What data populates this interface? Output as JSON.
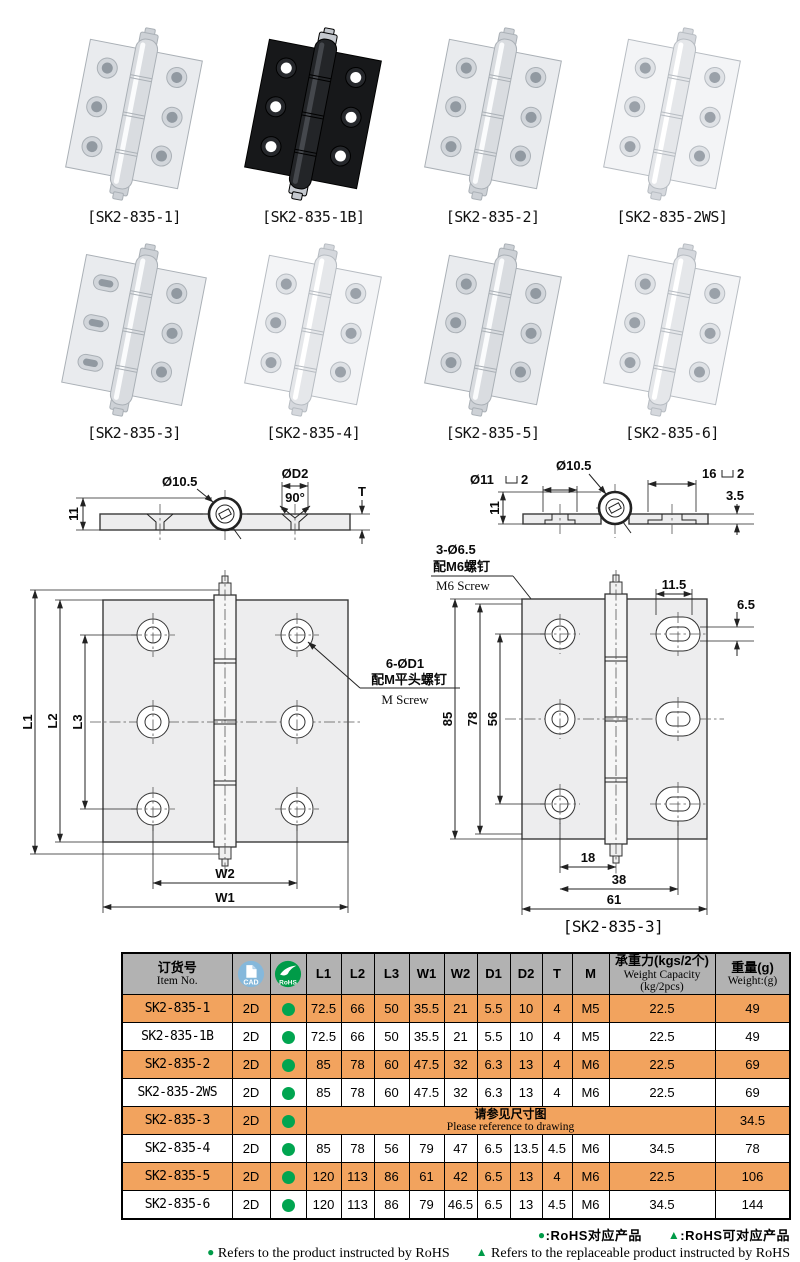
{
  "products": [
    {
      "label": "[SK2-835-1]",
      "finish": "silver"
    },
    {
      "label": "[SK2-835-1B]",
      "finish": "black"
    },
    {
      "label": "[SK2-835-2]",
      "finish": "silver"
    },
    {
      "label": "[SK2-835-2WS]",
      "finish": "white"
    },
    {
      "label": "[SK2-835-3]",
      "finish": "silver-slotted"
    },
    {
      "label": "[SK2-835-4]",
      "finish": "silver"
    },
    {
      "label": "[SK2-835-5]",
      "finish": "silver"
    },
    {
      "label": "[SK2-835-6]",
      "finish": "silver"
    }
  ],
  "drawings": {
    "cross_left": {
      "height": "11",
      "pin_dia": "Ø10.5",
      "csk_dia": "ØD2",
      "csk_angle": "90°",
      "thickness": "T"
    },
    "cross_right": {
      "cbore_dia": "Ø11",
      "cbore_depth": "2",
      "pin_dia": "Ø10.5",
      "cbore_w": "16",
      "cbore2_depth": "2",
      "plate_t": "3.5",
      "height": "11"
    },
    "m6_callout": {
      "holes": "3-Ø6.5",
      "cn": "配M6螺钉",
      "en": "M6 Screw"
    },
    "front_left": {
      "L1": "L1",
      "L2": "L2",
      "L3": "L3",
      "W2": "W2",
      "W1": "W1",
      "holes": "6-ØD1",
      "cn": "配M平头螺钉",
      "en": "M Screw"
    },
    "front_right": {
      "slot_w": "11.5",
      "slot_h": "6.5",
      "h85": "85",
      "h78": "78",
      "h56": "56",
      "w18": "18",
      "w38": "38",
      "w61": "61",
      "caption": "[SK2-835-3]"
    }
  },
  "table": {
    "header": {
      "item_cn": "订货号",
      "item_en": "Item No.",
      "cad": "CAD",
      "rohs": "RoHS",
      "dims": [
        "L1",
        "L2",
        "L3",
        "W1",
        "W2",
        "D1",
        "D2",
        "T",
        "M"
      ],
      "cap_cn": "承重力(kgs/2个)",
      "cap_en": "Weight Capacity (kg/2pcs)",
      "wt_cn": "重量(g)",
      "wt_en": "Weight:(g)"
    },
    "rows": [
      {
        "item": "SK2-835-1",
        "cad": "2D",
        "l1": "72.5",
        "l2": "66",
        "l3": "50",
        "w1": "35.5",
        "w2": "21",
        "d1": "5.5",
        "d2": "10",
        "t": "4",
        "m": "M5",
        "cap": "22.5",
        "wt": "49"
      },
      {
        "item": "SK2-835-1B",
        "cad": "2D",
        "l1": "72.5",
        "l2": "66",
        "l3": "50",
        "w1": "35.5",
        "w2": "21",
        "d1": "5.5",
        "d2": "10",
        "t": "4",
        "m": "M5",
        "cap": "22.5",
        "wt": "49"
      },
      {
        "item": "SK2-835-2",
        "cad": "2D",
        "l1": "85",
        "l2": "78",
        "l3": "60",
        "w1": "47.5",
        "w2": "32",
        "d1": "6.3",
        "d2": "13",
        "t": "4",
        "m": "M6",
        "cap": "22.5",
        "wt": "69"
      },
      {
        "item": "SK2-835-2WS",
        "cad": "2D",
        "l1": "85",
        "l2": "78",
        "l3": "60",
        "w1": "47.5",
        "w2": "32",
        "d1": "6.3",
        "d2": "13",
        "t": "4",
        "m": "M6",
        "cap": "22.5",
        "wt": "69"
      },
      {
        "item": "SK2-835-3",
        "cad": "2D",
        "note_cn": "请参见尺寸图",
        "note_en": "Please reference to drawing",
        "cap": "34.5",
        "wt": "65"
      },
      {
        "item": "SK2-835-4",
        "cad": "2D",
        "l1": "85",
        "l2": "78",
        "l3": "56",
        "w1": "79",
        "w2": "47",
        "d1": "6.5",
        "d2": "13.5",
        "t": "4.5",
        "m": "M6",
        "cap": "34.5",
        "wt": "78"
      },
      {
        "item": "SK2-835-5",
        "cad": "2D",
        "l1": "120",
        "l2": "113",
        "l3": "86",
        "w1": "61",
        "w2": "42",
        "d1": "6.5",
        "d2": "13",
        "t": "4",
        "m": "M6",
        "cap": "22.5",
        "wt": "106"
      },
      {
        "item": "SK2-835-6",
        "cad": "2D",
        "l1": "120",
        "l2": "113",
        "l3": "86",
        "w1": "79",
        "w2": "46.5",
        "d1": "6.5",
        "d2": "13",
        "t": "4.5",
        "m": "M6",
        "cap": "34.5",
        "wt": "144"
      }
    ]
  },
  "footnotes": {
    "cn_dot": "●",
    "cn_dot_text": ":RoHS对应产品",
    "cn_tri": "▲",
    "cn_tri_text": ":RoHS可对应产品",
    "en_dot": "●",
    "en_dot_text": "Refers to the product instructed by RoHS",
    "en_tri": "▲",
    "en_tri_text": "Refers to the replaceable product instructed by RoHS"
  },
  "colors": {
    "accent_orange": "#F2A35E",
    "rohs_green": "#009B48",
    "cad_blue": "#85B8DB",
    "header_gray": "#B2B2B2"
  }
}
